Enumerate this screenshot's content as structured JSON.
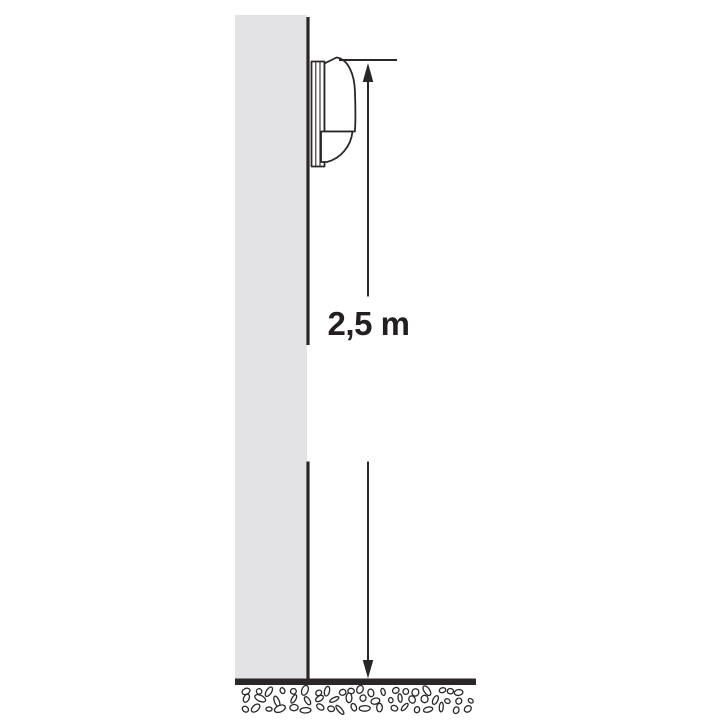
{
  "diagram": {
    "dimension_label": "2,5 m",
    "dimension": {
      "value": "2,5",
      "unit": "m"
    },
    "colors": {
      "background": "#ffffff",
      "wall_fill": "#e3e3e5",
      "line": "#2b2728",
      "text": "#231f20"
    },
    "icons": {
      "device": "motion-sensor-side-view",
      "arrow": "double-headed-vertical-arrow",
      "ground": "gravel-hatch"
    }
  }
}
